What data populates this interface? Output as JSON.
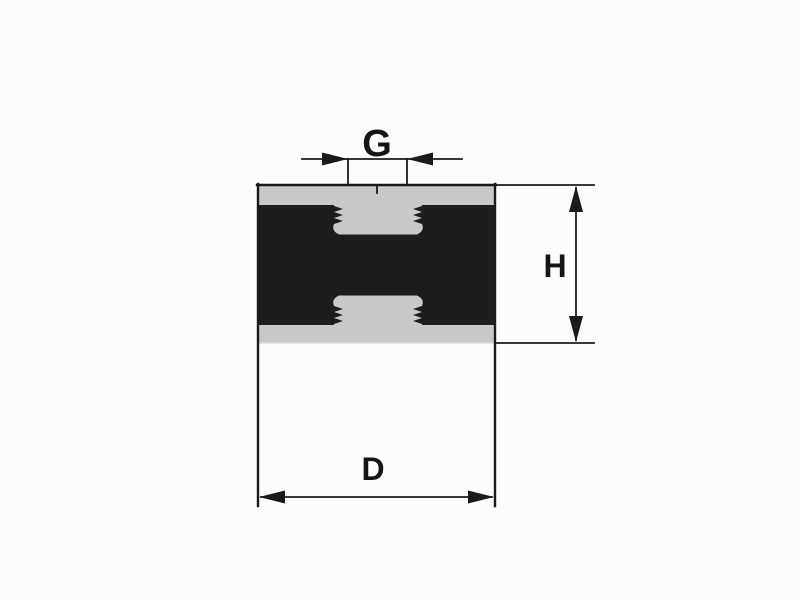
{
  "diagram": {
    "labels": {
      "thread_diameter": "G",
      "height": "H",
      "diameter": "D"
    },
    "colors": {
      "line": "#1a1a1a",
      "rubber_body": "#1d1d1d",
      "metal_plate": "#c9c9c9",
      "background": "#fdfcfc"
    }
  }
}
